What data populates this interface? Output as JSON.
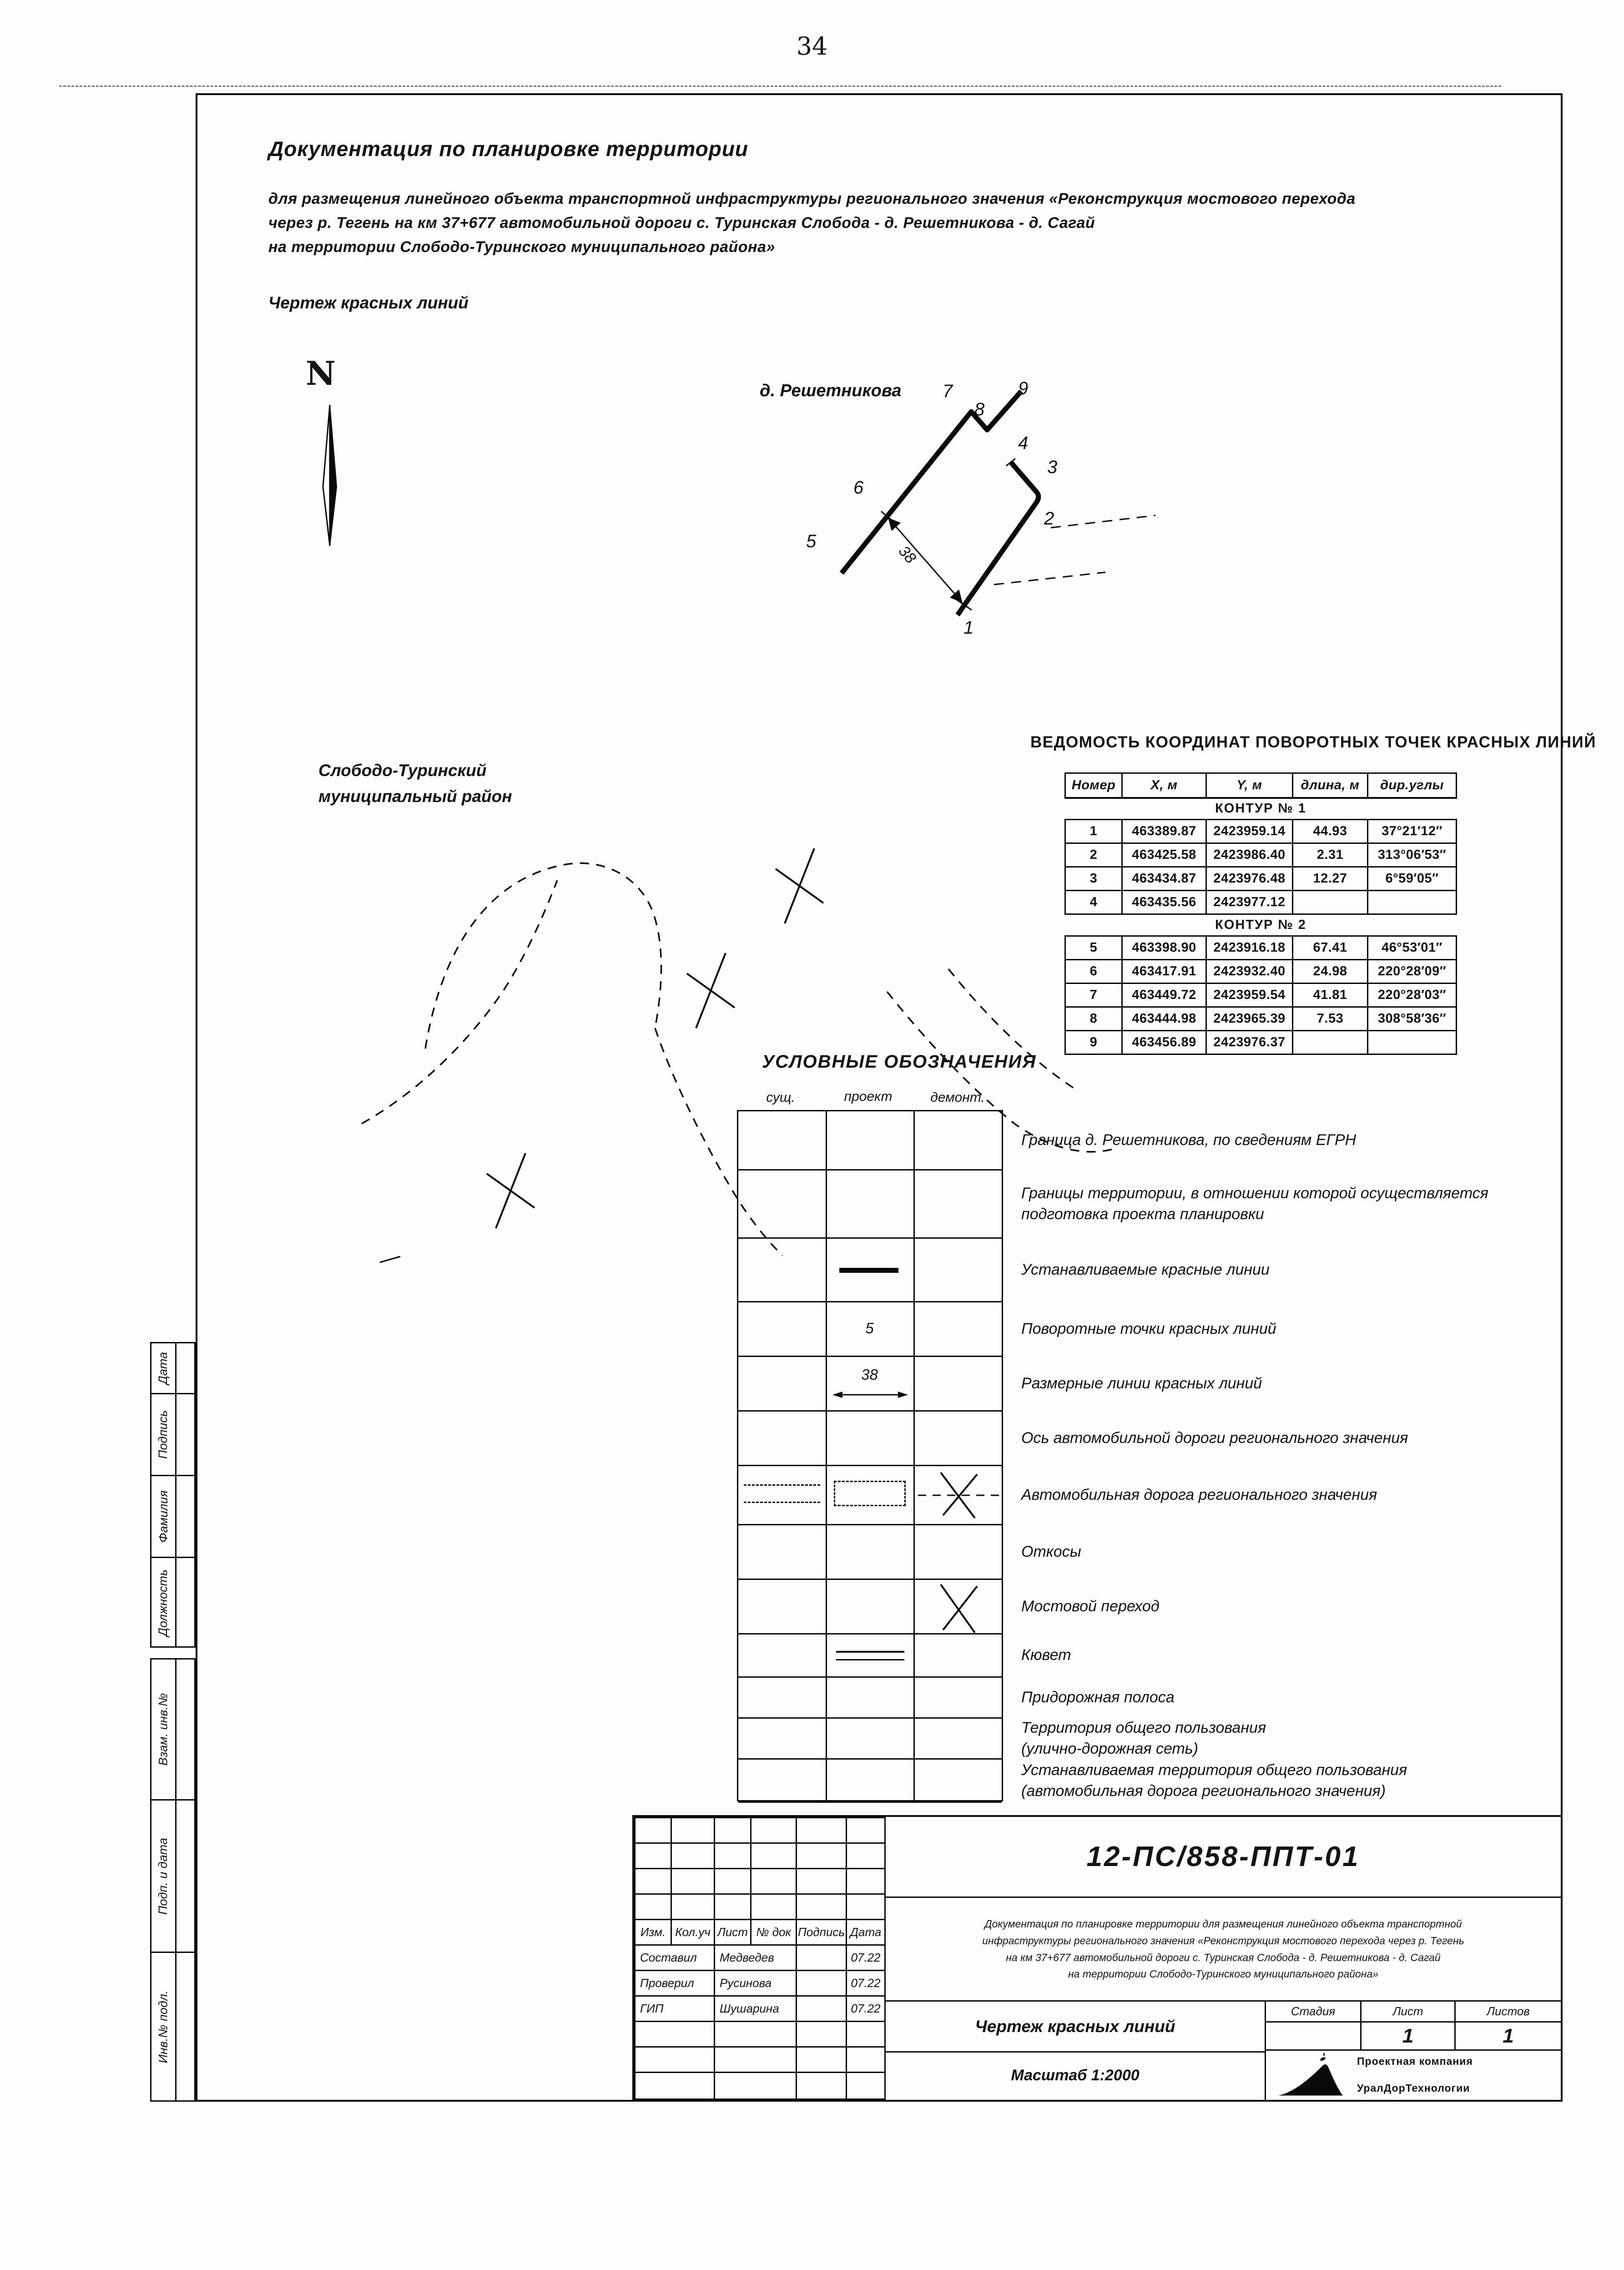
{
  "page": {
    "number": "34"
  },
  "header": {
    "title": "Документация по планировке территории",
    "subtitle_lines": [
      "для размещения линейного объекта транспортной инфраструктуры регионального значения «Реконструкция мостового перехода",
      "через р. Тегень на км 37+677 автомобильной дороги с. Туринская Слобода - д. Решетникова - д. Сагай",
      "на территории Слободо-Туринского муниципального района»"
    ],
    "drawing_name": "Чертеж красных линий"
  },
  "drawing": {
    "north_letter": "N",
    "settlement_label": "д. Решетникова",
    "dimension": "38",
    "point_labels": [
      "1",
      "2",
      "3",
      "4",
      "5",
      "6",
      "7",
      "8",
      "9"
    ]
  },
  "map": {
    "label_line1": "Слободо-Туринский",
    "label_line2": "муниципальный район"
  },
  "coords_table": {
    "title": "ВЕДОМОСТЬ КООРДИНАТ ПОВОРОТНЫХ ТОЧЕК КРАСНЫХ ЛИНИЙ",
    "headers": [
      "Номер",
      "Х, м",
      "Y, м",
      "длина, м",
      "дир.углы"
    ],
    "sections": [
      {
        "name": "КОНТУР № 1",
        "rows": [
          [
            "1",
            "463389.87",
            "2423959.14",
            "44.93",
            "37°21′12″"
          ],
          [
            "2",
            "463425.58",
            "2423986.40",
            "2.31",
            "313°06′53″"
          ],
          [
            "3",
            "463434.87",
            "2423976.48",
            "12.27",
            "6°59′05″"
          ],
          [
            "4",
            "463435.56",
            "2423977.12",
            "",
            ""
          ]
        ]
      },
      {
        "name": "КОНТУР № 2",
        "rows": [
          [
            "5",
            "463398.90",
            "2423916.18",
            "67.41",
            "46°53′01″"
          ],
          [
            "6",
            "463417.91",
            "2423932.40",
            "24.98",
            "220°28′09″"
          ],
          [
            "7",
            "463449.72",
            "2423959.54",
            "41.81",
            "220°28′03″"
          ],
          [
            "8",
            "463444.98",
            "2423965.39",
            "7.53",
            "308°58′36″"
          ],
          [
            "9",
            "463456.89",
            "2423976.37",
            "",
            ""
          ]
        ]
      }
    ]
  },
  "legend": {
    "title": "УСЛОВНЫЕ ОБОЗНАЧЕНИЯ",
    "col_headers": [
      "сущ.",
      "проект",
      "демонт."
    ],
    "point_symbol": "5",
    "dim_symbol": "38",
    "rows": [
      {
        "label": "Граница д. Решетникова, по сведениям ЕГРН"
      },
      {
        "label": "Границы территории, в отношении которой осуществляется",
        "label2": "подготовка проекта планировки"
      },
      {
        "label": "Устанавливаемые красные линии"
      },
      {
        "label": "Поворотные точки красных линий"
      },
      {
        "label": "Размерные линии красных линий"
      },
      {
        "label": "Ось автомобильной дороги регионального значения"
      },
      {
        "label": "Автомобильная дорога регионального значения"
      },
      {
        "label": "Откосы"
      },
      {
        "label": "Мостовой переход"
      },
      {
        "label": "Кювет"
      },
      {
        "label": "Придорожная полоса"
      },
      {
        "label": "Территория общего пользования",
        "label2": "(улично-дорожная сеть)"
      },
      {
        "label": "Устанавливаемая территория общего пользования",
        "label2": "(автомобильная дорога регионального значения)"
      }
    ]
  },
  "sidebar": {
    "top_labels": [
      "Дата",
      "Подпись",
      "Фамилия",
      "Должность"
    ],
    "bottom_labels": [
      "Взам. инв.№",
      "Подп. и дата",
      "Инв.№ подл."
    ]
  },
  "stamp": {
    "doc_number": "12-ПС/858-ППТ-01",
    "description_lines": [
      "Документация по планировке территории для размещения линейного объекта транспортной",
      "инфраструктуры регионального значения «Реконструкция мостового перехода через р. Тегень",
      "на км 37+677 автомобильной дороги с. Туринская Слобода - д. Решетникова - д. Сагай",
      "на территории Слободо-Туринского муниципального района»"
    ],
    "revision_headers": [
      "Изм.",
      "Кол.уч",
      "Лист",
      "№ док",
      "Подпись",
      "Дата"
    ],
    "signature_rows": [
      {
        "role": "Составил",
        "name": "Медведев",
        "date": "07.22"
      },
      {
        "role": "Проверил",
        "name": "Русинова",
        "date": "07.22"
      },
      {
        "role": "ГИП",
        "name": "Шушарина",
        "date": "07.22"
      }
    ],
    "drawing_title": "Чертеж красных линий",
    "scale_label": "Масштаб 1:2000",
    "stage_headers": [
      "Стадия",
      "Лист",
      "Листов"
    ],
    "sheet_number": "1",
    "total_sheets": "1",
    "company_line1": "Проектная компания",
    "company_line2": "УралДорТехнологии"
  }
}
